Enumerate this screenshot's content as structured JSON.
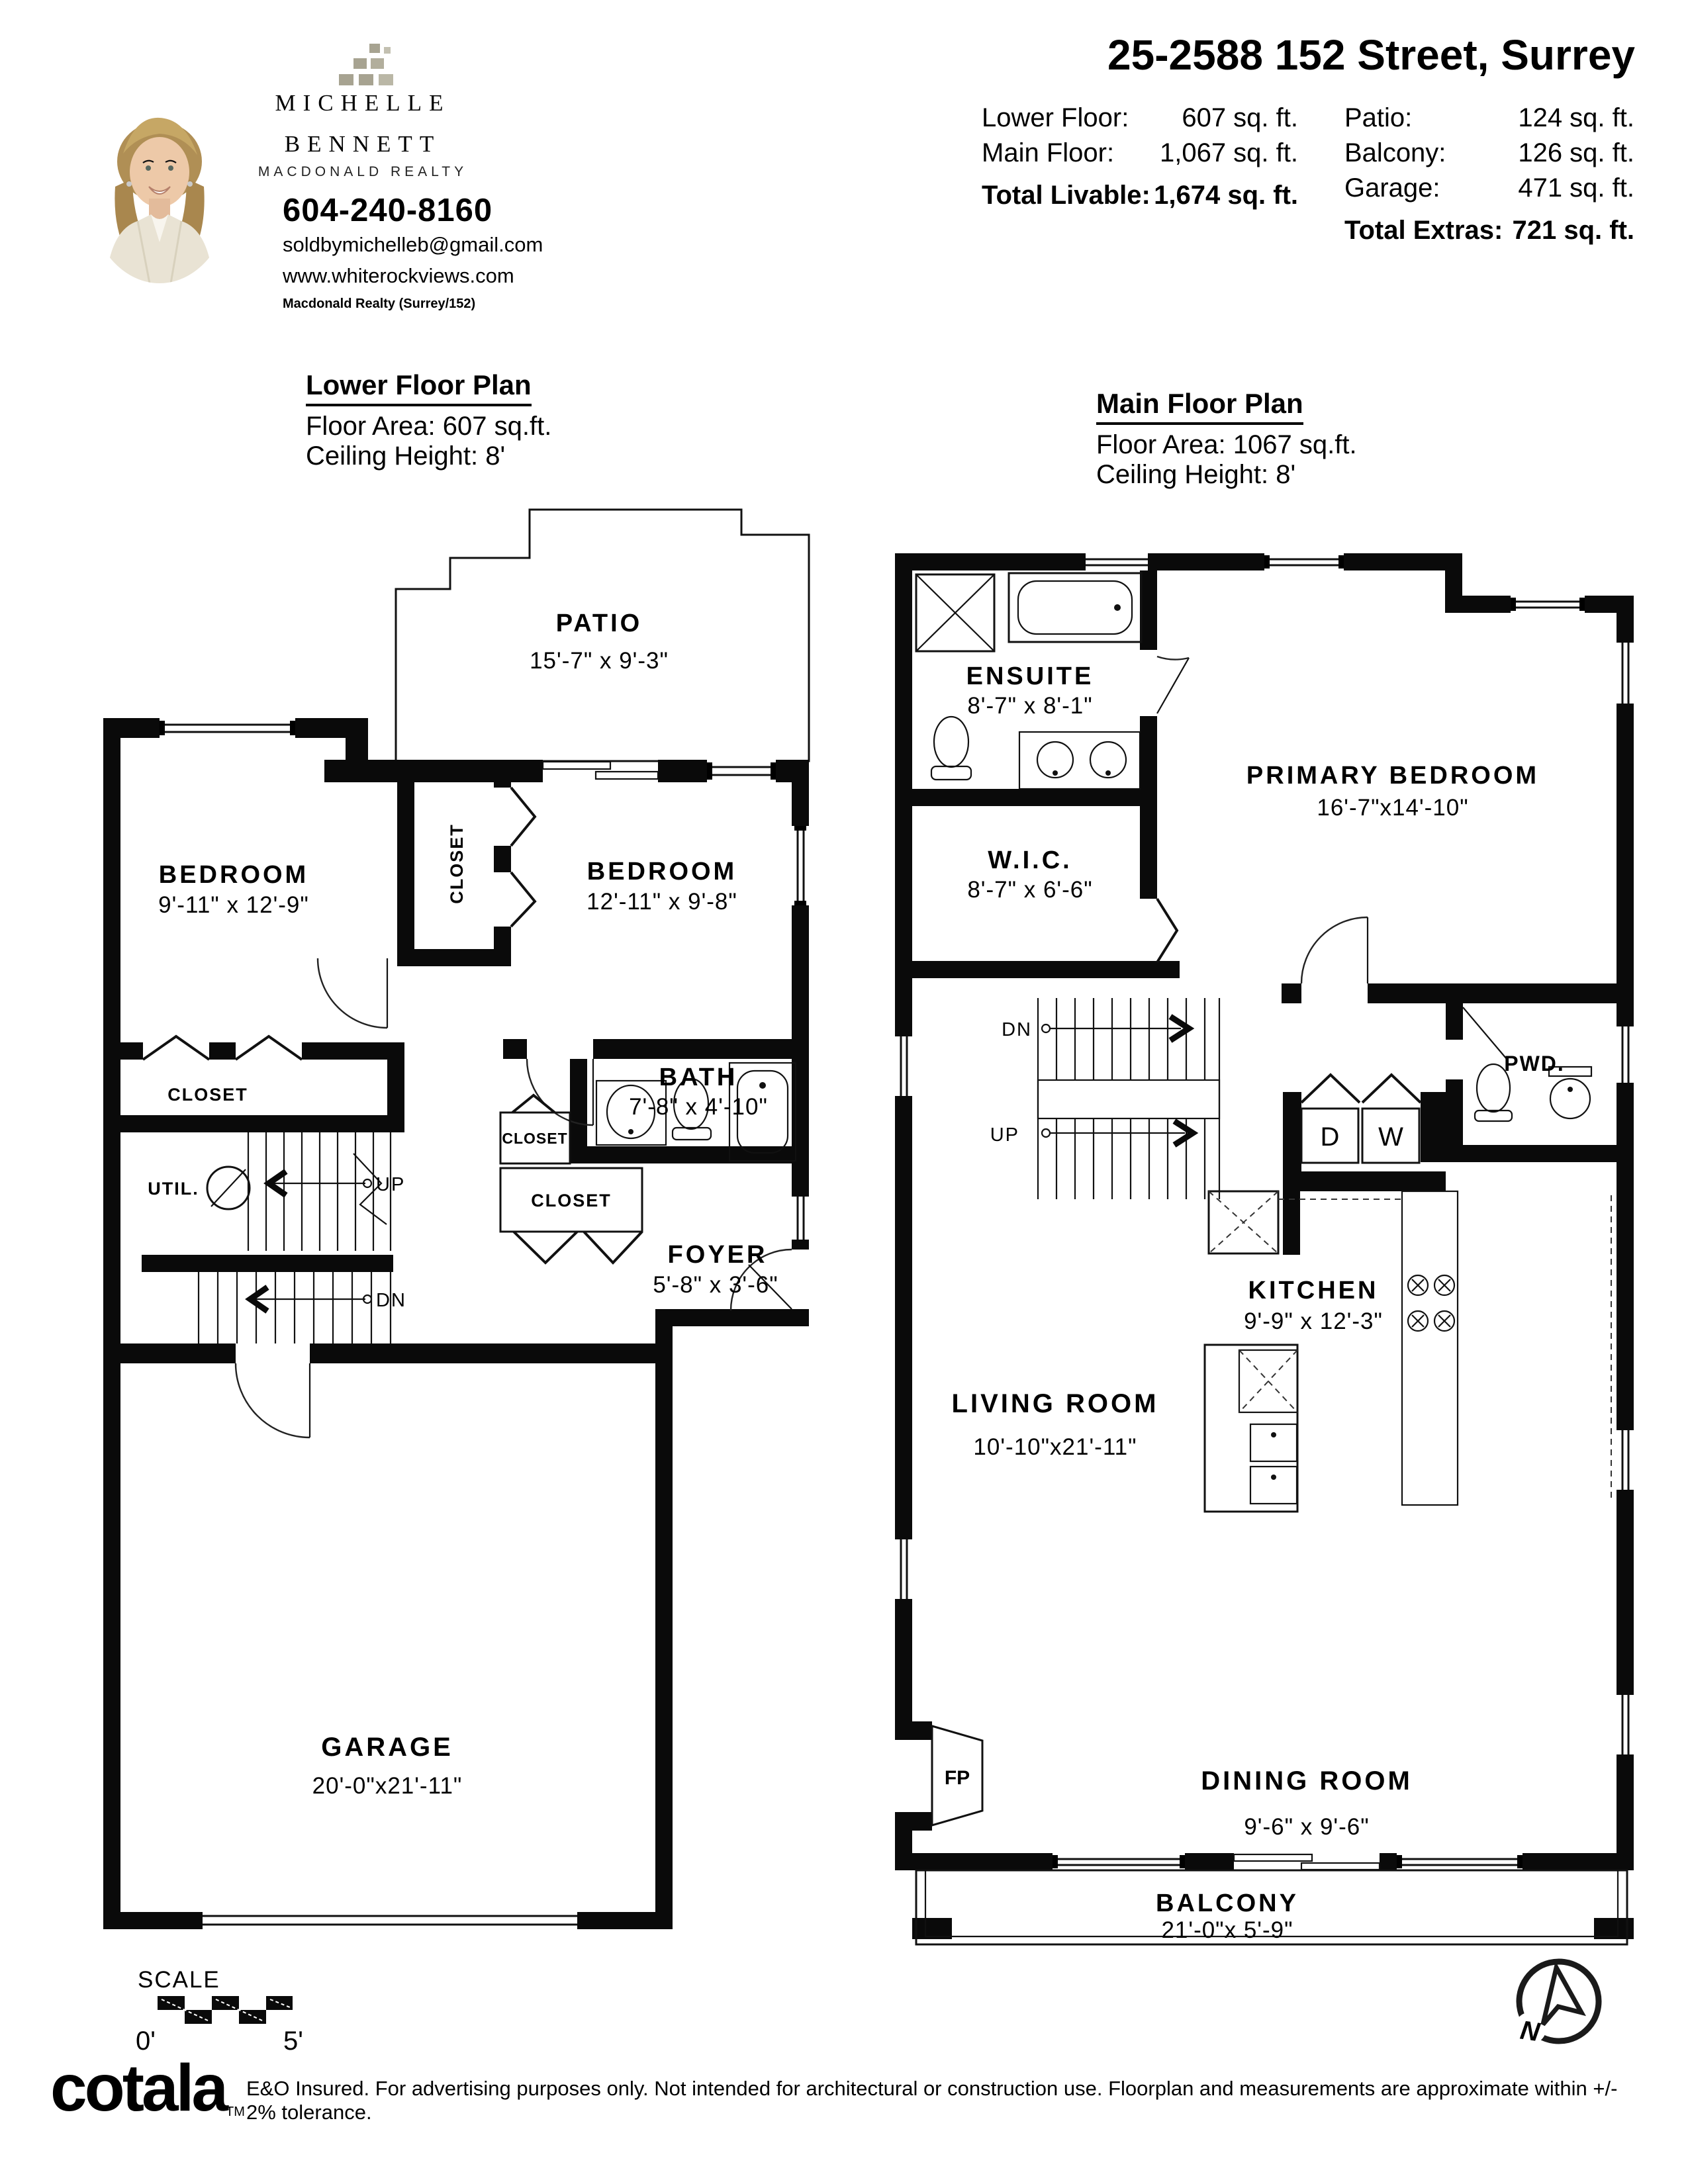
{
  "agent": {
    "first_name": "MICHELLE",
    "last_name": "BENNETT",
    "brokerage": "MACDONALD REALTY",
    "phone": "604-240-8160",
    "email": "soldbymichelleb@gmail.com",
    "website": "www.whiterockviews.com",
    "office": "Macdonald Realty (Surrey/152)"
  },
  "listing": {
    "title": "25-2588 152 Street, Surrey",
    "stats_left": [
      {
        "label": "Lower Floor:",
        "value": "607 sq. ft."
      },
      {
        "label": "Main Floor:",
        "value": "1,067 sq. ft."
      }
    ],
    "total_livable_label": "Total Livable:",
    "total_livable_value": "1,674 sq. ft.",
    "stats_right": [
      {
        "label": "Patio:",
        "value": "124 sq. ft."
      },
      {
        "label": "Balcony:",
        "value": "126 sq. ft."
      },
      {
        "label": "Garage:",
        "value": "471 sq. ft."
      }
    ],
    "total_extras_label": "Total Extras:",
    "total_extras_value": "721 sq. ft."
  },
  "plans": {
    "lower": {
      "title": "Lower Floor Plan",
      "floor_area": "Floor Area: 607 sq.ft.",
      "ceiling_height": "Ceiling Height: 8'",
      "rooms": {
        "patio": {
          "name": "PATIO",
          "dims": "15'-7\" x  9'-3\""
        },
        "bedroom_left": {
          "name": "BEDROOM",
          "dims": "9'-11\" x 12'-9\""
        },
        "closet_mid": {
          "name": "CLOSET"
        },
        "bedroom_right": {
          "name": "BEDROOM",
          "dims": "12'-11\" x  9'-8\""
        },
        "closet_left": {
          "name": "CLOSET"
        },
        "util": {
          "name": "UTIL."
        },
        "up": "UP",
        "dn": "DN",
        "bath": {
          "name": "BATH",
          "dims": "7'-8\"  x 4'-10\""
        },
        "closet_small": {
          "name": "CLOSET"
        },
        "closet_wide": {
          "name": "CLOSET"
        },
        "foyer": {
          "name": "FOYER",
          "dims": "5'-8\" x  3'-6\""
        },
        "garage": {
          "name": "GARAGE",
          "dims": "20'-0\"x21'-11\""
        }
      }
    },
    "main": {
      "title": "Main Floor Plan",
      "floor_area": "Floor Area: 1067 sq.ft.",
      "ceiling_height": "Ceiling Height: 8'",
      "rooms": {
        "ensuite": {
          "name": "ENSUITE",
          "dims": "8'-7\" x 8'-1\""
        },
        "wic": {
          "name": "W.I.C.",
          "dims": "8'-7\" x 6'-6\""
        },
        "primary": {
          "name": "PRIMARY BEDROOM",
          "dims": "16'-7\"x14'-10\""
        },
        "dn": "DN",
        "up": "UP",
        "dryer": "D",
        "washer": "W",
        "pwd": {
          "name": "PWD."
        },
        "kitchen": {
          "name": "KITCHEN",
          "dims": "9'-9\" x 12'-3\""
        },
        "living": {
          "name": "LIVING ROOM",
          "dims": "10'-10\"x21'-11\""
        },
        "fireplace": "FP",
        "dining": {
          "name": "DINING ROOM",
          "dims": "9'-6\" x  9'-6\""
        },
        "balcony": {
          "name": "BALCONY",
          "dims": "21'-0\"x  5'-9\""
        }
      }
    }
  },
  "footer": {
    "scale_label": "SCALE",
    "scale_zero": "0'",
    "scale_five": "5'",
    "north": "N",
    "logo": "cotala",
    "logo_tm": "TM",
    "disclaimer": "E&O Insured. For advertising purposes only. Not intended for architectural or construction use. Floorplan and measurements are approximate within +/- 2% tolerance."
  }
}
